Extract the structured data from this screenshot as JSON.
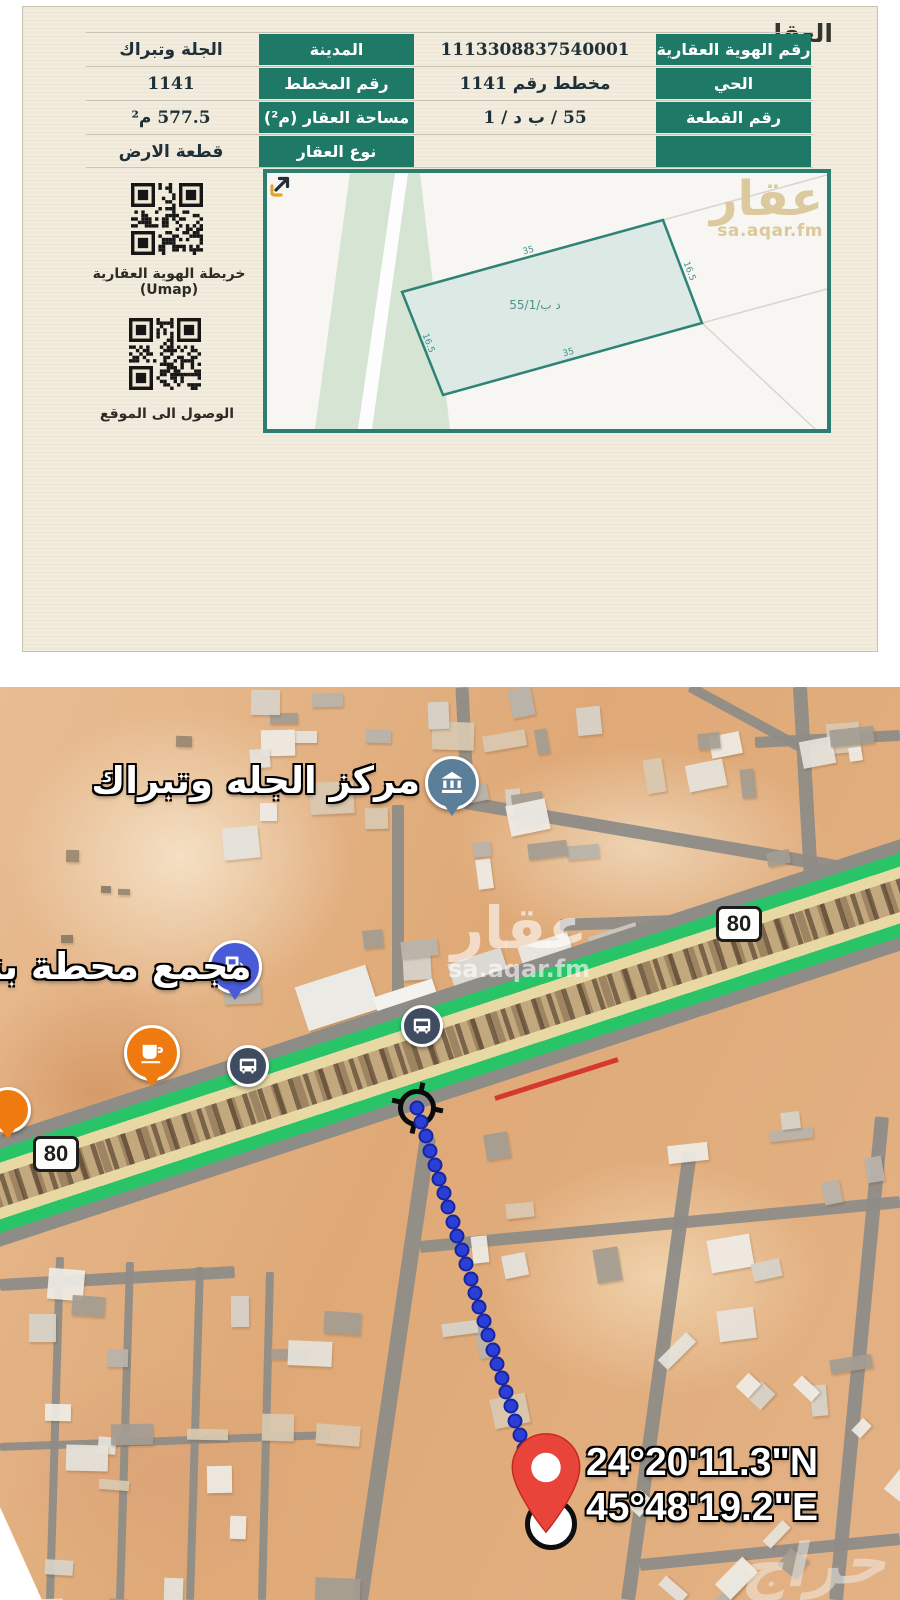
{
  "colors": {
    "green": "#1e7a66",
    "cream": "#f0e9d7",
    "teal-border": "#2c7f70",
    "highway-green": "#29c468",
    "highway-tan": "#e7d8a4",
    "pin-red": "#e8443a",
    "dot-blue": "#2a3fd6",
    "red-line": "#d5382c"
  },
  "document": {
    "title": "العقار",
    "table": {
      "rows": [
        {
          "h1": "رقم الهوية العقارية",
          "v1": "1113308837540001",
          "h2": "المدينة",
          "v2": "الجلة وتبراك"
        },
        {
          "h1": "الحي",
          "v1": "مخطط رقم 1141",
          "h2": "رقم المخطط",
          "v2": "1141"
        },
        {
          "h1": "رقم القطعة",
          "v1": "55 / ب د / 1",
          "h2": "مساحة العقار (م²)",
          "v2": "577.5 م²"
        },
        {
          "h1": "",
          "v1": "",
          "h2": "نوع العقار",
          "v2": "قطعة الارض"
        }
      ]
    },
    "qr_map_label": "خريطة الهوية العقارية (Umap)",
    "qr_location_label": "الوصول الى الموقع",
    "plan": {
      "plot_label": "55/1/د ب",
      "dim_long": "35",
      "dim_short": "16.5",
      "watermark_title": "عقار",
      "watermark_sub": "sa.aqar.fm"
    }
  },
  "map": {
    "poi_center_label": "مركز الجله وتبراك",
    "poi_station_label": "مجمع محطة بتر",
    "route_shield": "80",
    "coords_n": "24°20'11.3\"N",
    "coords_e": "45°48'19.2\"E",
    "watermark_title": "عقار",
    "watermark_sub": "sa.aqar.fm",
    "corner_watermark": "حراج"
  }
}
